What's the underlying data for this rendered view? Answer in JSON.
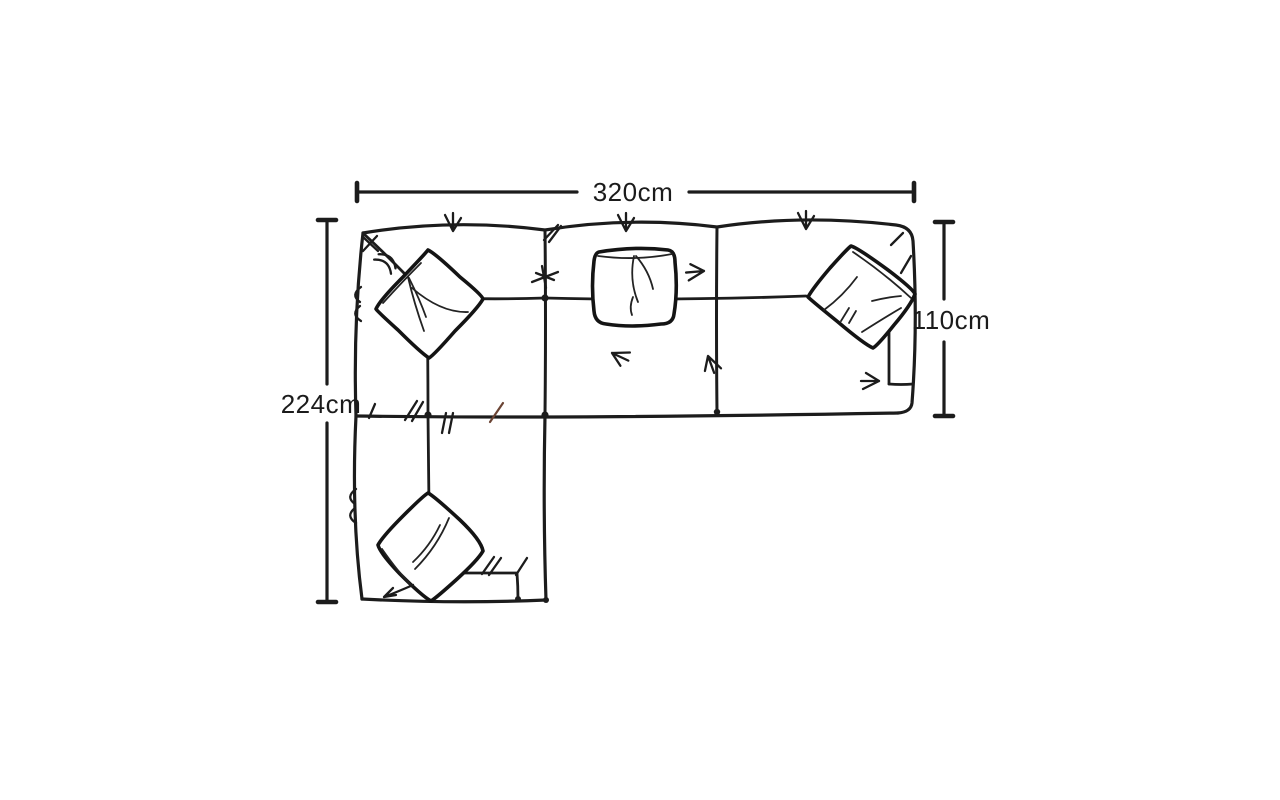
{
  "page": {
    "background_color": "#ffffff",
    "ink_color": "#1c1c1c"
  },
  "diagram": {
    "name": "corner-sofa-top-view-dimension-drawing",
    "labels": {
      "overall_width": "320cm",
      "left_depth": "224cm",
      "right_depth": "110cm"
    }
  }
}
